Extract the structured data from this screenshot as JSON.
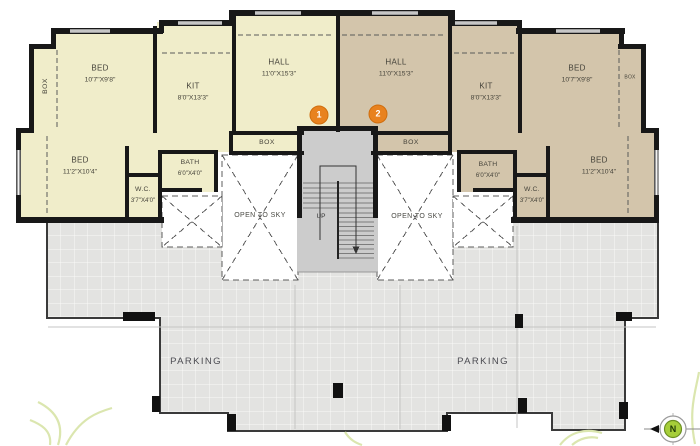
{
  "colors": {
    "unit1_fill": "#f0edca",
    "unit2_fill": "#d3c5ab",
    "wall": "#181818",
    "parking_fill": "#e3e3e1",
    "stair_fill": "#cccccc",
    "open_to_sky_fill": "#ffffff",
    "marker_orange": "#e8821f",
    "compass_green": "#a6ce39",
    "label_text": "#45433a"
  },
  "unit1": {
    "marker": "1",
    "hall": {
      "name": "HALL",
      "dims": "11'0\"X15'3\""
    },
    "kit": {
      "name": "KIT",
      "dims": "8'0\"X13'3\""
    },
    "bed_top": {
      "name": "BED",
      "dims": "10'7\"X9'8\""
    },
    "bed_bottom": {
      "name": "BED",
      "dims": "11'2\"X10'4\""
    },
    "bath": {
      "name": "BATH",
      "dims": "6'0\"X4'0\""
    },
    "wc": {
      "name": "W.C.",
      "dims": "3'7\"X4'0\""
    },
    "box_side": "BOX",
    "box_hall": "BOX"
  },
  "unit2": {
    "marker": "2",
    "hall": {
      "name": "HALL",
      "dims": "11'0\"X15'3\""
    },
    "kit": {
      "name": "KIT",
      "dims": "8'0\"X13'3\""
    },
    "bed_top": {
      "name": "BED",
      "dims": "10'7\"X9'8\""
    },
    "bed_bottom": {
      "name": "BED",
      "dims": "11'2\"X10'4\""
    },
    "bath": {
      "name": "BATH",
      "dims": "6'0\"X4'0\""
    },
    "wc": {
      "name": "W.C.",
      "dims": "3'7\"X4'0\""
    },
    "box_side": "BOX",
    "box_hall": "BOX"
  },
  "common": {
    "open_to_sky": "OPEN TO SKY",
    "up": "UP",
    "parking": "PARKING",
    "north": "N"
  }
}
